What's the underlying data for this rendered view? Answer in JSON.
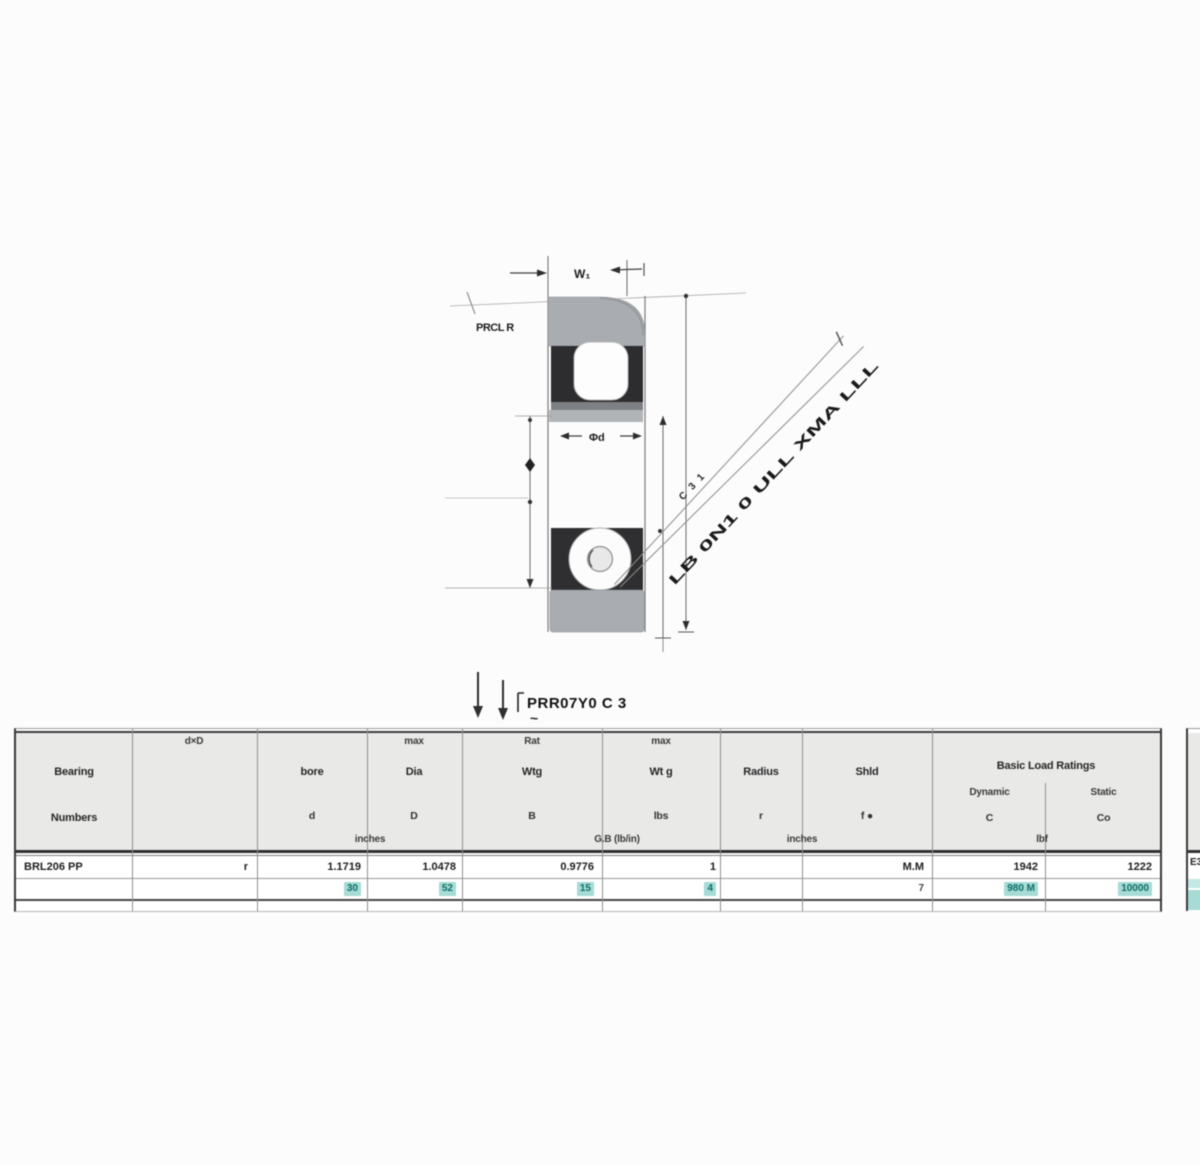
{
  "drawing": {
    "width_dim_label": "W₁",
    "bore_dim_label": "Φd",
    "corner_callout": "PRCL R",
    "leader_note_small": "C 3 1",
    "leader_note_large": "LB 0N1 0 ULL XMA LLL",
    "pointer_note": "PRR07Y0 C 3",
    "pointer_note_tilde": "~"
  },
  "table": {
    "headers": {
      "bearing_line1": "Bearing",
      "bearing_line2": "Numbers",
      "col2_top": "d×D",
      "bore_label": "bore",
      "bore_sym": "d",
      "dia_top": "max",
      "dia_label": "Dia",
      "dia_sym": "D",
      "width_top": "Rat",
      "width_label": "Wtg",
      "width_sym": "B",
      "weight_top": "max",
      "weight_label": "Wt g",
      "weight_sym": "lbs",
      "radius_label": "Radius",
      "radius_sym": "r",
      "shield_label": "Shld",
      "shield_sym": "f ●",
      "load_label": "Basic Load Ratings",
      "load_dynamic": "Dynamic",
      "load_static": "Static",
      "load_dyn_sym": "C",
      "load_stat_sym": "Co",
      "unit_inches1": "inches",
      "unit_mid": "G.B (lb/in)",
      "unit_inches2": "inches",
      "unit_load": "lbf"
    },
    "row1": {
      "bearing": "BRL206 PP",
      "c2": "r",
      "bore": "1.1719",
      "dia": "1.0478",
      "width": "0.9776",
      "c6": "1",
      "shield": "M.M",
      "dynamic": "1942",
      "static": "1222"
    },
    "row2": {
      "bore": "30",
      "dia": "52",
      "width": "15",
      "c6": "4",
      "shield": "7",
      "dynamic": "980 M",
      "static": "10000"
    }
  },
  "edge_fragment": {
    "row_text": "E3"
  },
  "colors": {
    "header_bg": "#e9e9e8",
    "teal_highlight": "#a6dbd6",
    "teal_text": "#0d6e68",
    "ring_gray": "#a9adb2",
    "dark_band": "#2d2d2f",
    "border_dark": "#3a3a3a"
  }
}
